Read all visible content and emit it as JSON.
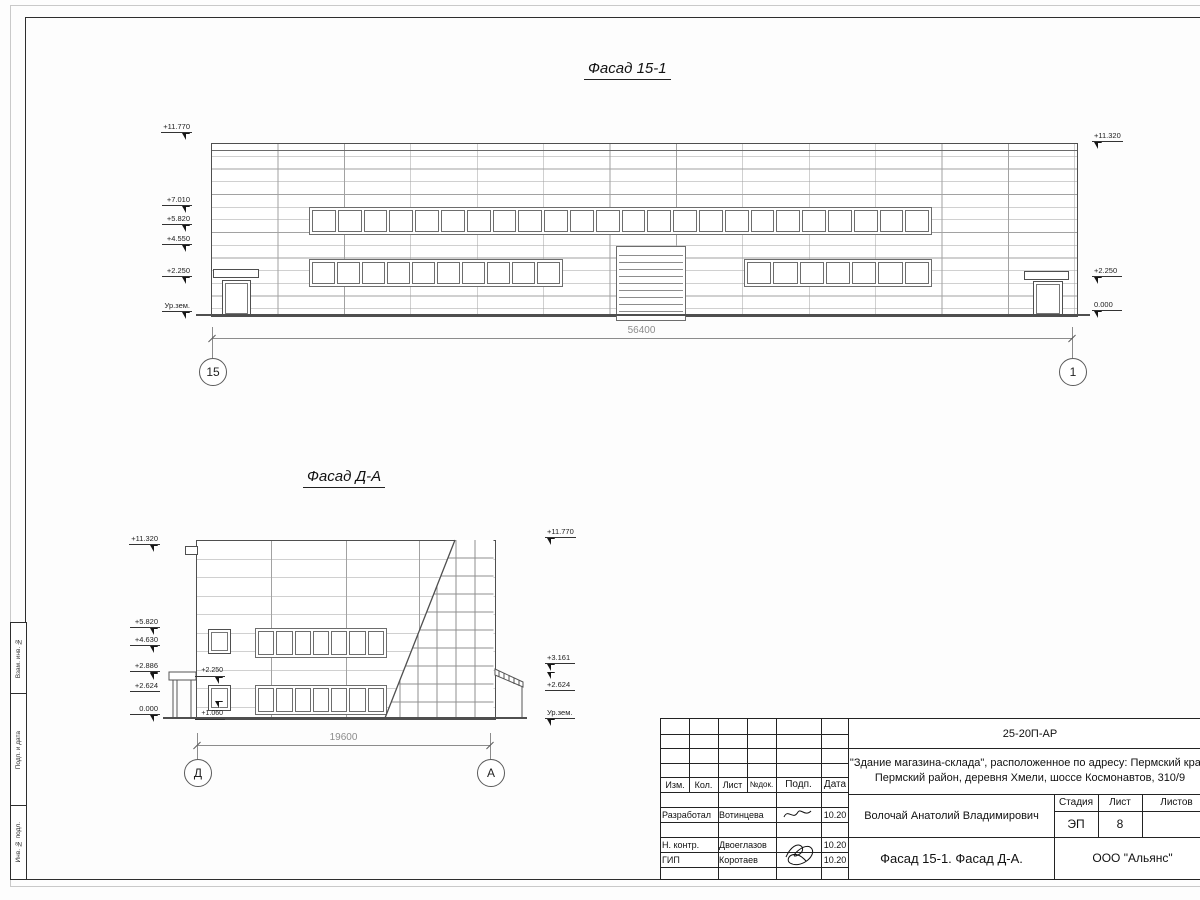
{
  "frame": {
    "side_labels": [
      "Взам. инв. №",
      "Подп. и дата",
      "Инв. № подл."
    ]
  },
  "f1": {
    "title": "Фасад 15-1",
    "marks_left": [
      "+11.770",
      "+7.010",
      "+5.820",
      "+4.550",
      "+2.250",
      "Ур.зем."
    ],
    "marks_right": [
      "+11.320",
      "+2.250",
      "0.000"
    ],
    "dim": "56400",
    "axis_left": "15",
    "axis_right": "1",
    "upper_band_panes": 24,
    "lower_left_band_panes": 10,
    "lower_right_band_panes": 7,
    "gate_slats": 10
  },
  "f2": {
    "title": "Фасад Д-А",
    "marks_left": [
      "+11.320",
      "+5.820",
      "+4.630",
      "+2.886",
      "+2.624",
      "0.000"
    ],
    "marks_right": [
      "+11.770",
      "+3.161",
      "+2.624",
      "Ур.зем."
    ],
    "inner_marks": [
      "+2.250",
      "+1.060"
    ],
    "dim": "19600",
    "axis_left": "Д",
    "axis_right": "А",
    "upper_band_panes": 7,
    "lower_band_panes": 7
  },
  "tb": {
    "doc_number": "25-20П-АР",
    "object_line1": "\"Здание магазина-склада\", расположенное по адресу: Пермский край,",
    "object_line2": "Пермский район, деревня Хмели, шоссе Космонавтов, 310/9",
    "cols": [
      "Изм.",
      "Кол.",
      "Лист",
      "№док.",
      "Подп.",
      "Дата"
    ],
    "rows": [
      {
        "role": "Разработал",
        "name": "Вотинцева",
        "date": "10.20"
      },
      {
        "role": "Н. контр.",
        "name": "Двоеглазов",
        "date": "10.20"
      },
      {
        "role": "ГИП",
        "name": "Коротаев",
        "date": "10.20"
      }
    ],
    "supervisor": "Волочай Анатолий Владимирович",
    "stage_label": "Стадия",
    "sheet_label": "Лист",
    "sheets_label": "Листов",
    "stage": "ЭП",
    "sheet": "8",
    "title": "Фасад 15-1. Фасад Д-А.",
    "company": "ООО \"Альянс\""
  }
}
